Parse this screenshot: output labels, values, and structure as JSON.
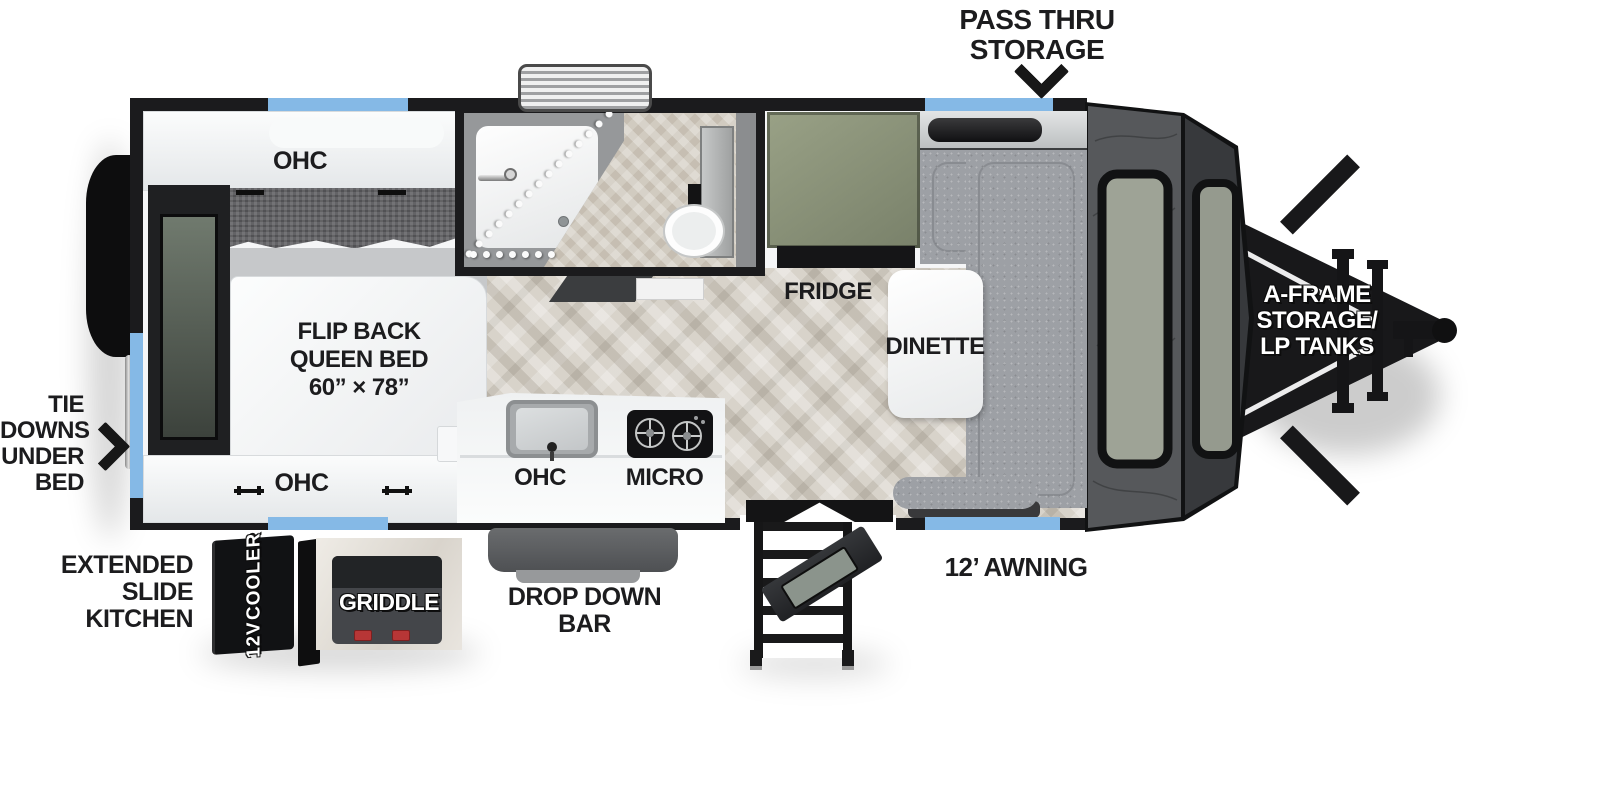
{
  "title": "Travel trailer floor plan",
  "labels": {
    "pass_thru": {
      "line1": "PASS THRU",
      "line2": "STORAGE"
    },
    "tie_downs": {
      "line1": "TIE",
      "line2": "DOWNS",
      "line3": "UNDER",
      "line4": "BED"
    },
    "extended_slide": {
      "line1": "EXTENDED",
      "line2": "SLIDE",
      "line3": "KITCHEN"
    },
    "awning": "12’ AWNING",
    "a_frame": {
      "line1": "A-FRAME",
      "line2": "STORAGE/",
      "line3": "LP TANKS"
    },
    "drop_down_bar": {
      "line1": "DROP DOWN",
      "line2": "BAR"
    },
    "cooler": {
      "line1": "12V",
      "line2": "COOLER"
    },
    "griddle": "GRIDDLE",
    "ohc_rear_top": "OHC",
    "ohc_rear_bottom": "OHC",
    "ohc_kitchen": "OHC",
    "micro": "MICRO",
    "fridge": "FRIDGE",
    "dinette": "DINETTE",
    "bed": {
      "line1": "FLIP BACK",
      "line2": "QUEEN BED",
      "line3": "60” × 78”"
    }
  },
  "colors": {
    "accent_blue": "#85b9e6",
    "wall_black": "#1b1b1d",
    "label_ink": "#1c1c1e",
    "fridge_green": "#8a9176",
    "dinette_gray": "#9da0a5",
    "floor_wood": "#d8d3ca",
    "bath_tile": "#d1cbc0",
    "front_cap": "#56585b",
    "front_cap_dark": "#37393c",
    "window_glass": "#9ea396"
  }
}
